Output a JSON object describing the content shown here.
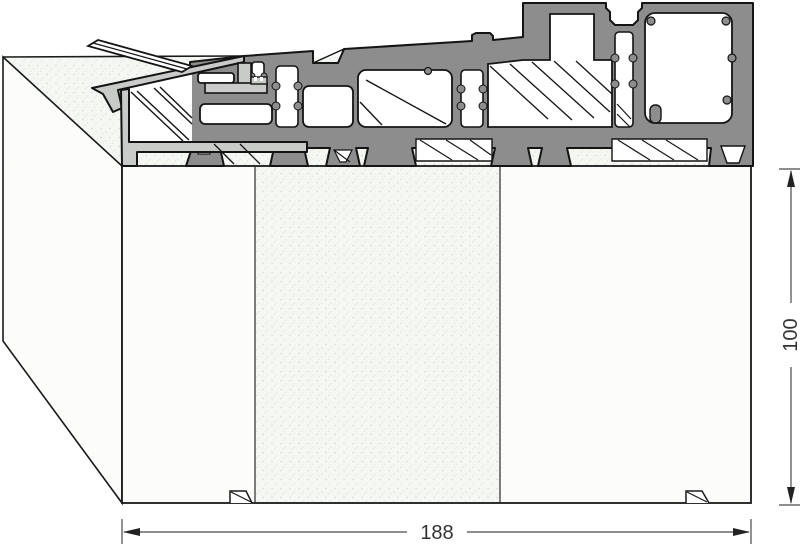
{
  "drawing": {
    "name": "threshold-profile-cross-section",
    "dimensions": {
      "width_label": "188",
      "height_label": "100"
    },
    "colors": {
      "profile_dark": "#8d8d8d",
      "profile_end_cap": "#c9cbc9",
      "outline": "#141414",
      "substrate_face": "#fcfcfb",
      "substrate_speckle": "#d9e0d8",
      "dimension_line": "#4a4a4a",
      "dimension_text": "#333333"
    }
  }
}
